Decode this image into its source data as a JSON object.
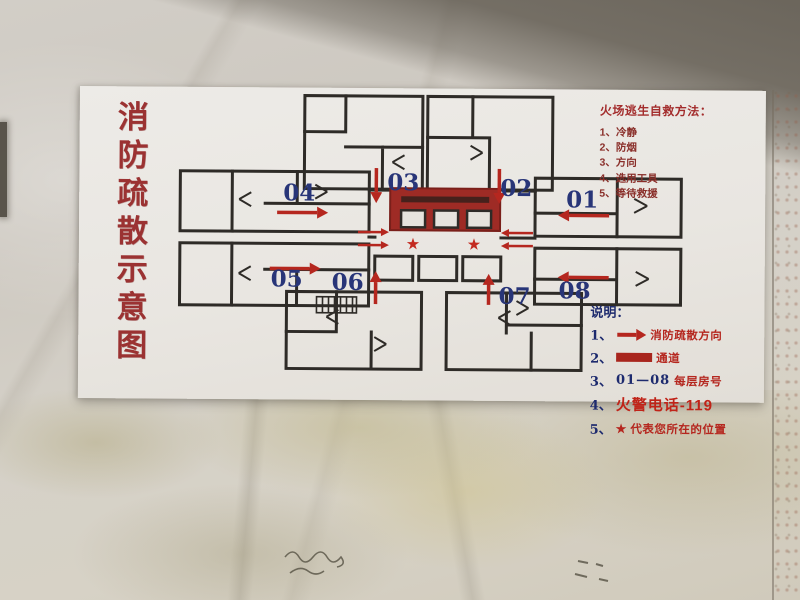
{
  "sign": {
    "vertical_title": "消防疏散示意图",
    "escape_guide": {
      "title": "火场逃生自救方法：",
      "items": [
        "1、冷静",
        "2、防烟",
        "3、方向",
        "4、选用工具",
        "5、等待救援"
      ]
    },
    "legend": {
      "title": "说明：",
      "item1": {
        "num": "1、",
        "text": "消防疏散方向"
      },
      "item2": {
        "num": "2、",
        "text": "通道"
      },
      "item3": {
        "num": "3、",
        "range": "01—08",
        "text": "每层房号"
      },
      "item4": {
        "num": "4、",
        "text": "火警电话-119"
      },
      "item5": {
        "num": "5、",
        "star": "★",
        "text": "代表您所在的位置"
      }
    },
    "plan": {
      "star": "★",
      "rooms": {
        "r01": "01",
        "r02": "02",
        "r03": "03",
        "r04": "04",
        "r05": "05",
        "r06": "06",
        "r07": "07",
        "r08": "08"
      },
      "evacuation_directions": {
        "r01": "left",
        "r02": "down",
        "r03": "down",
        "r04": "right",
        "r05": "right",
        "r06": "up",
        "r07": "up",
        "r08": "left"
      }
    },
    "colors": {
      "title_red": "#9b3232",
      "room_number_blue": "#283578",
      "arrow_red": "#b5271f",
      "corridor_red": "#9e2b25",
      "wall_dark": "#2e2b27"
    }
  }
}
